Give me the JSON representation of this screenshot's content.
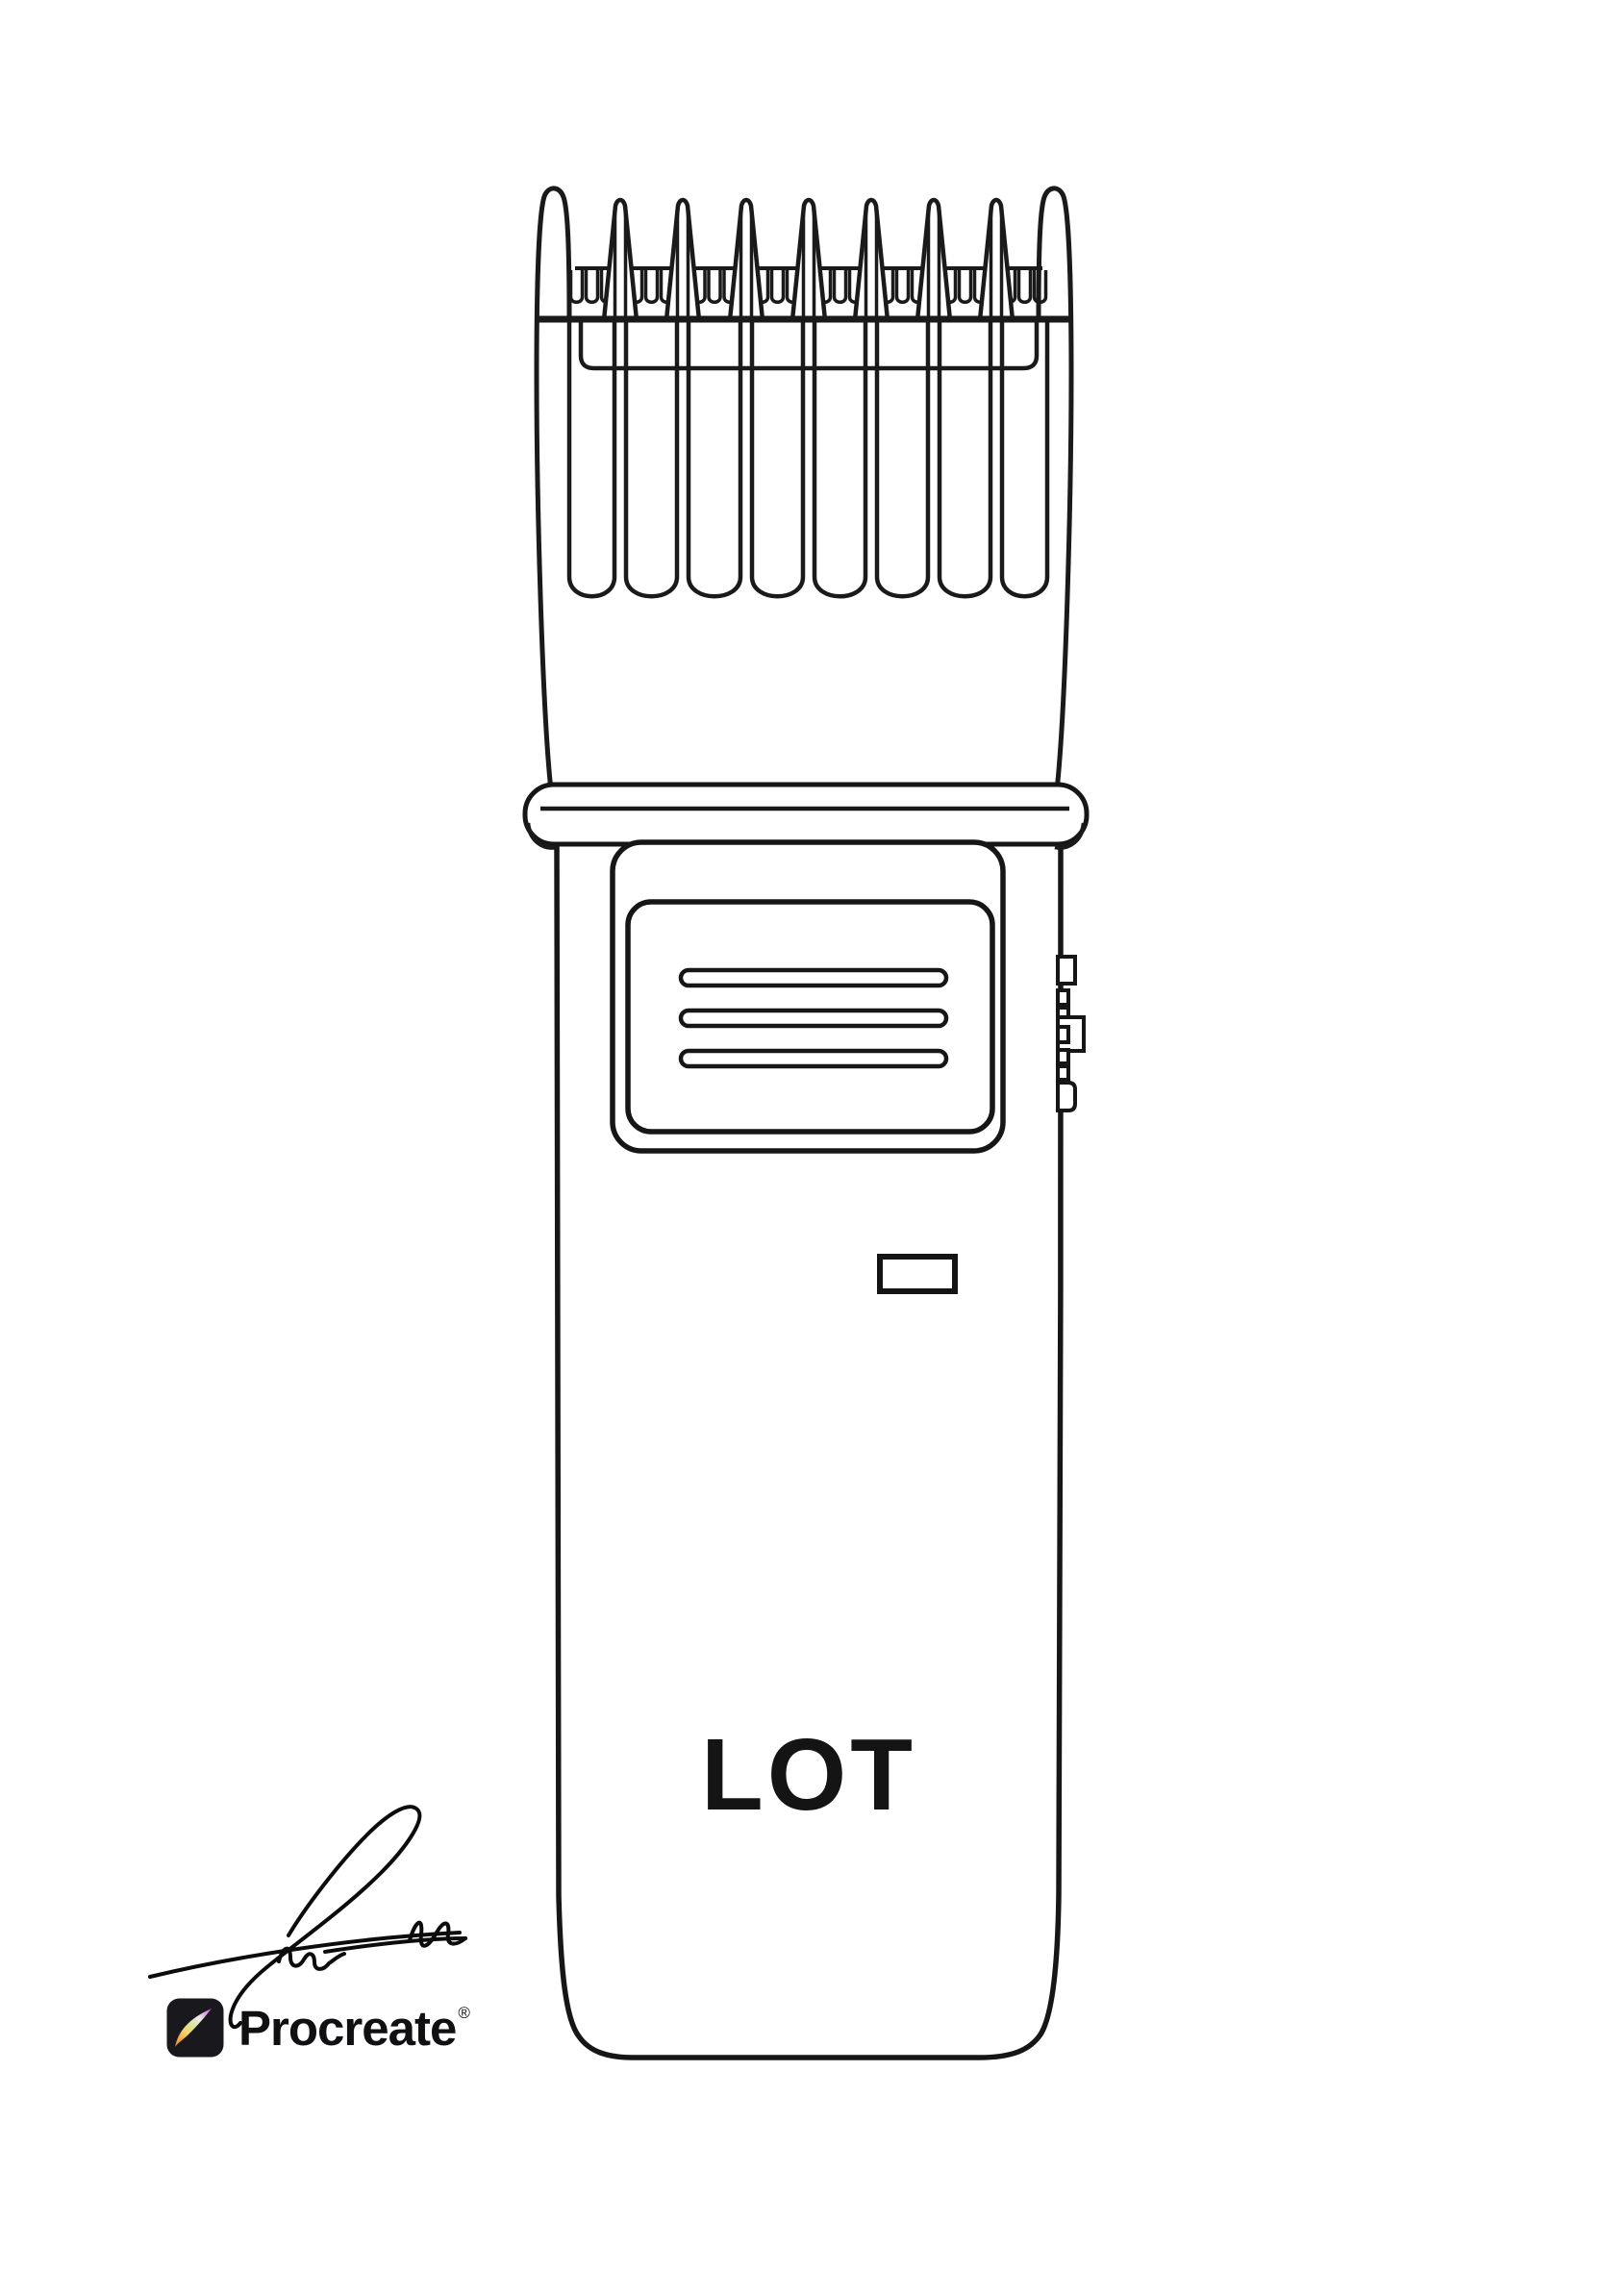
{
  "illustration": {
    "subject": "cordless hair trimmer with guide comb attachment, black line drawing on white",
    "device_label": "LOT",
    "line_color": "#1a1a1a",
    "background": "#ffffff"
  },
  "footer": {
    "signature": "handwritten artist signature",
    "brand": {
      "wordmark": "Procreate",
      "registered": "®",
      "icon_bg": "#19191d",
      "brush_gradient": [
        "#e04b1e",
        "#ee8b31",
        "#f3d469",
        "#d8e6a0",
        "#efe9ea",
        "#c36bdf",
        "#7034ee"
      ]
    }
  }
}
